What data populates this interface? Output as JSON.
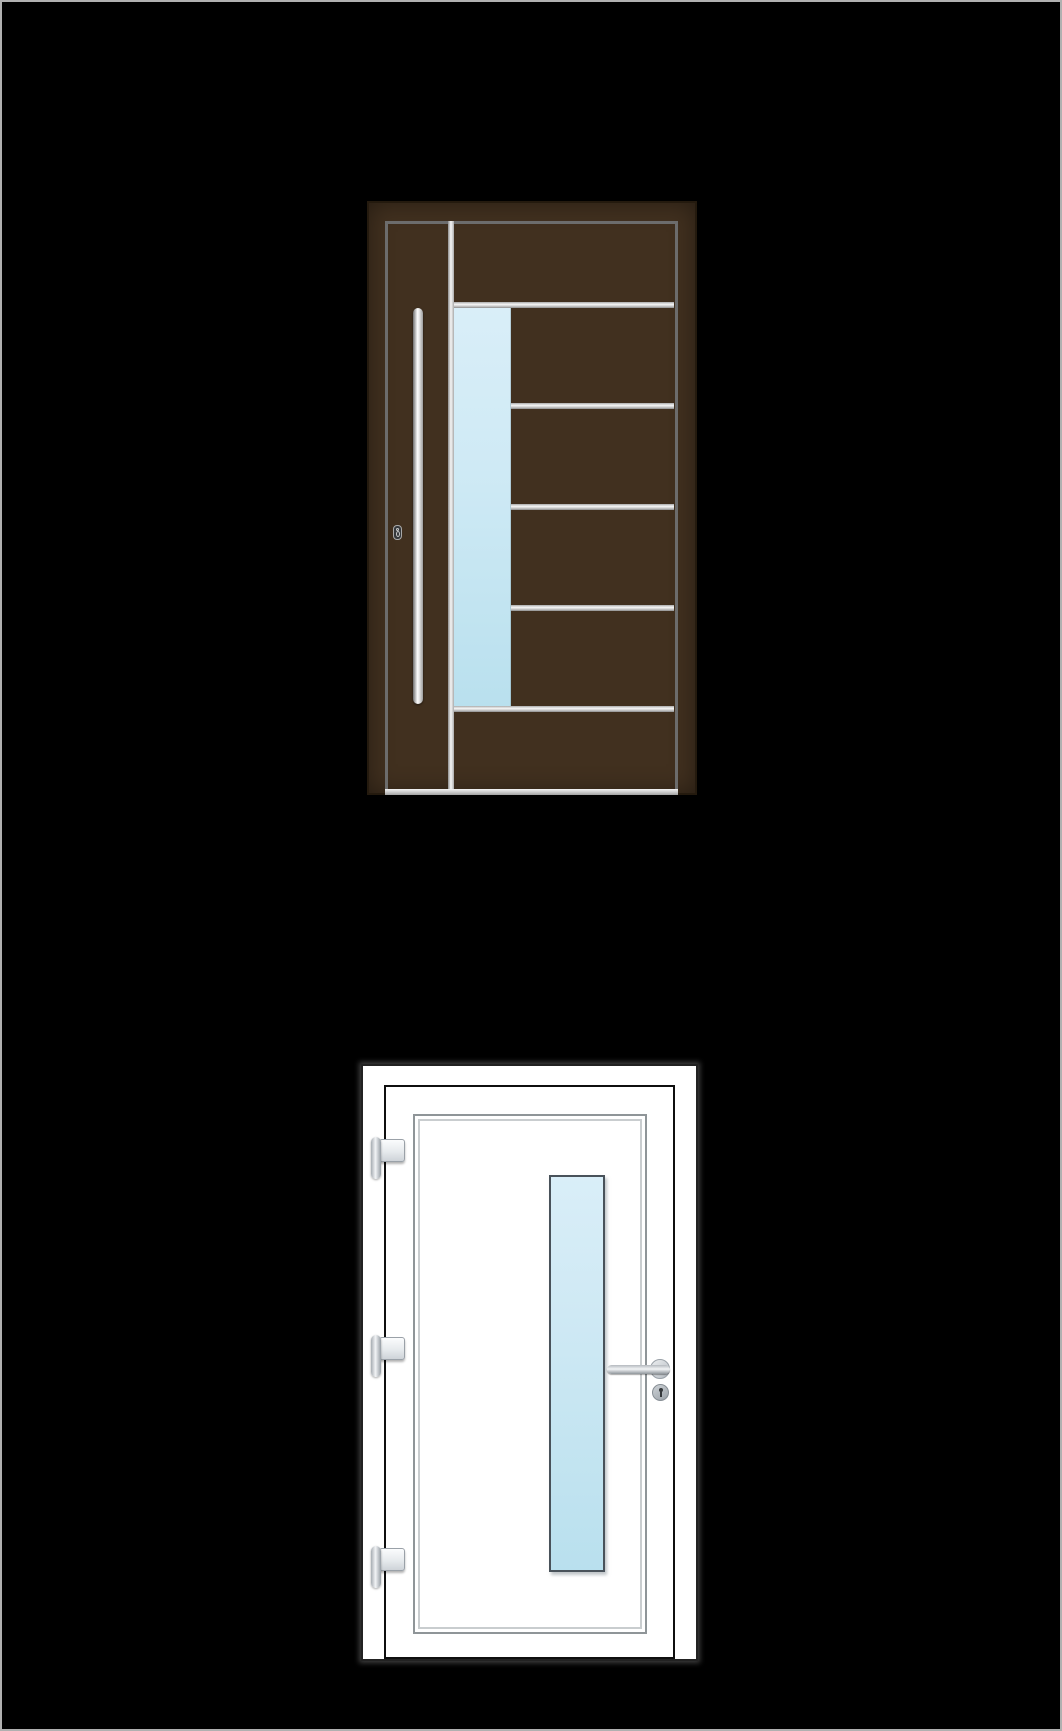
{
  "page": {
    "background_color": "#000000",
    "border_color": "#b0b0b0"
  },
  "doors": [
    {
      "id": "dark-brown-entrance-door",
      "position": "top",
      "leaf_color": "#41301f",
      "inner_frame_line_color": "#6c6c6c",
      "horizontal_trim_count": 5,
      "vertical_trim_count": 1,
      "glass_strip_side": "left-of-center",
      "handle_type": "vertical-bar",
      "handle_side": "left",
      "has_cylinder_lock": true
    },
    {
      "id": "white-entrance-door",
      "position": "bottom",
      "leaf_color": "#ffffff",
      "outline_color": "#222222",
      "panel_border_style": "double-line",
      "glass_strip_side": "right-of-center",
      "hinge_count": 3,
      "hinge_side": "left",
      "handle_type": "lever",
      "handle_side": "right",
      "has_cylinder_lock": true
    }
  ],
  "theme": {
    "page-bg": "#000000",
    "page-border": "#b0b0b0",
    "brown-leaf": "#41301f",
    "brown-edge": "#241a0e",
    "brown-frame-line": "#6c6c6c",
    "metal-light": "#f7f7f7",
    "metal-mid": "#c9c9c9",
    "metal-dark": "#8d8d8d",
    "glass-top": "#d9eef8",
    "glass-bottom": "#b9e0ee",
    "white-leaf": "#ffffff",
    "white-outline": "#222222",
    "leaf-line": "#0f0f0f",
    "panel-line-outer": "#8f9598",
    "panel-line-inner": "#c9cdcf",
    "hw-light": "#f2f4f6",
    "hw-mid": "#c6cbd0",
    "hw-border": "#9aa1a8",
    "lock-dark": "#35383b"
  }
}
